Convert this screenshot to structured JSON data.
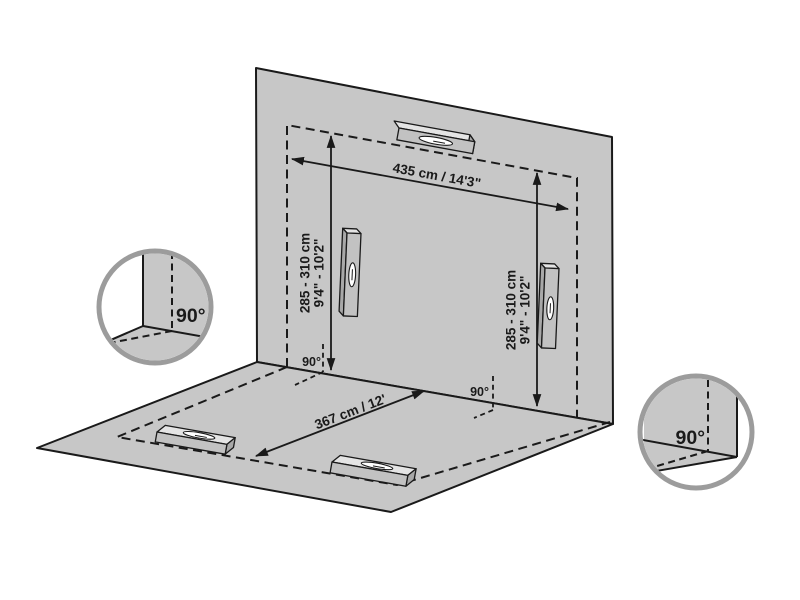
{
  "diagram": {
    "labels": {
      "wall_width": "435 cm / 14'3\"",
      "height_cm": "285 - 310 cm",
      "height_ft": "9'4\" - 10'2\"",
      "floor_depth": "367 cm / 12'",
      "right_angle": "90°"
    },
    "colors": {
      "surface": "#c7c7c7",
      "line": "#1a1a1a",
      "white": "#ffffff",
      "callout_border": "#9c9c9c",
      "level_front": "#c2c2c2",
      "level_top": "#e4e4e4",
      "level_side": "#a8a8a8"
    }
  }
}
